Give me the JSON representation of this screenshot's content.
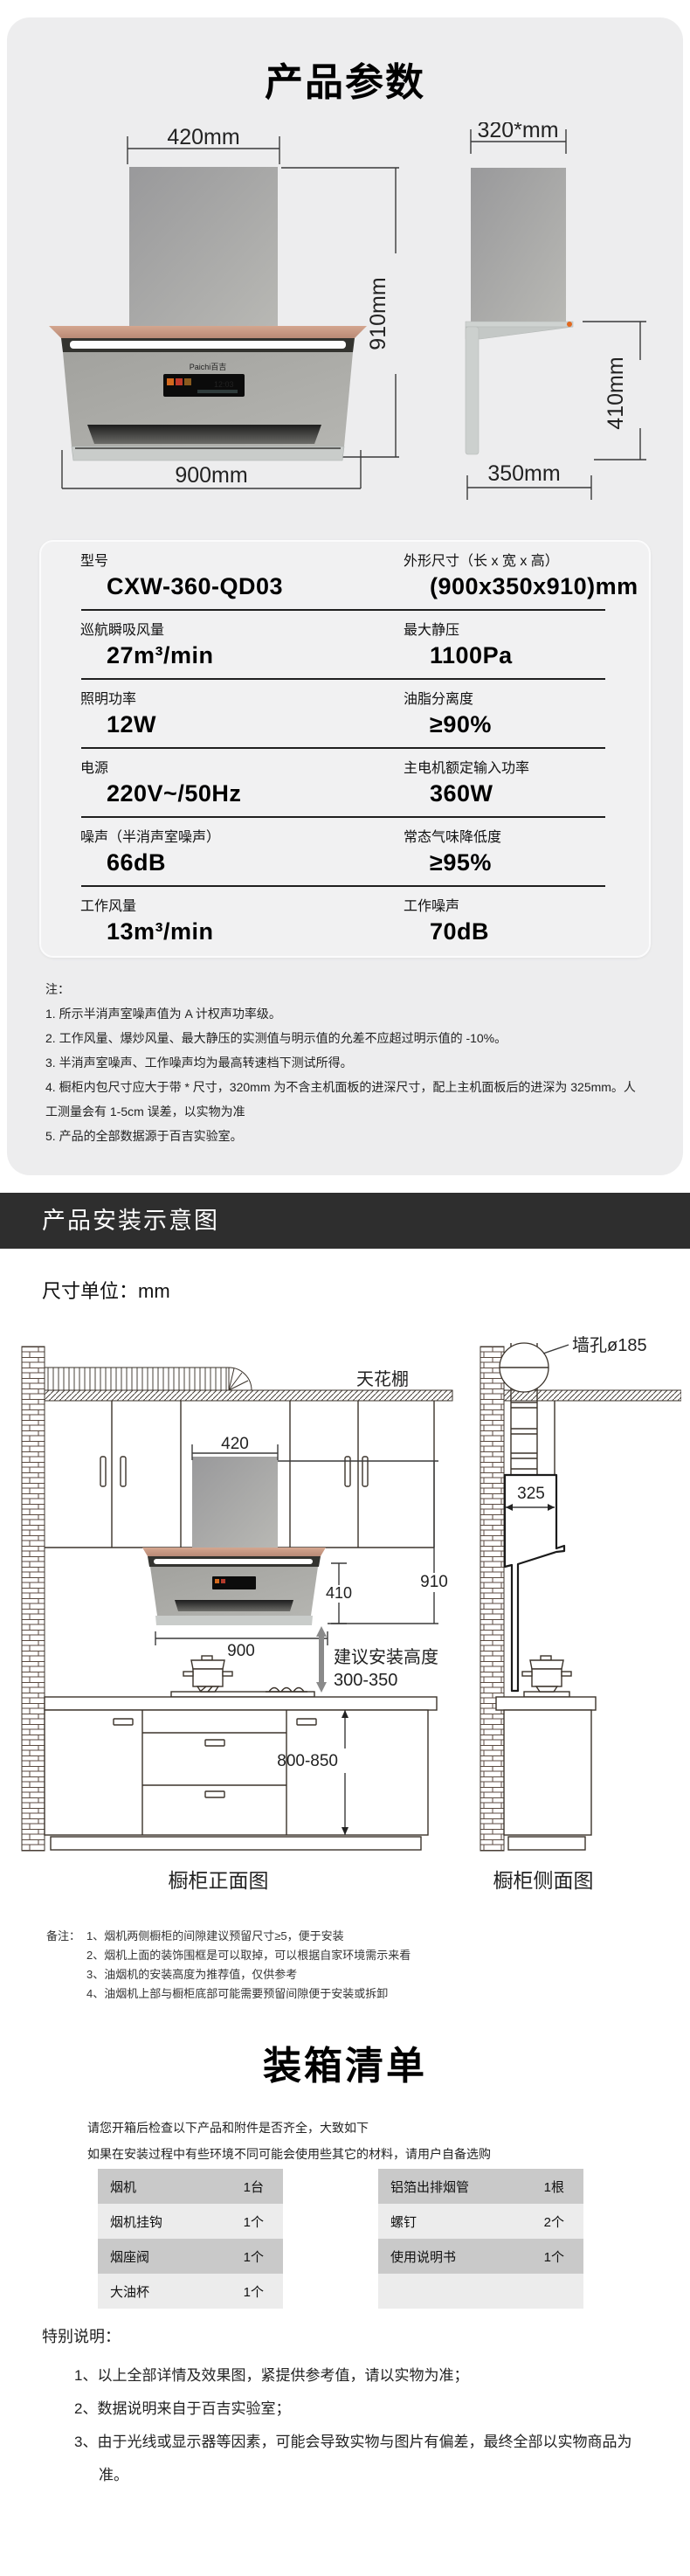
{
  "section_params": {
    "title": "产品参数",
    "front_view": {
      "width_top": "420mm",
      "height": "910mm",
      "width_bottom": "900mm",
      "brand": "Paichi百吉",
      "screen_time": "12:03"
    },
    "side_view": {
      "depth_top": "320*mm",
      "height": "410mm",
      "depth_bottom": "350mm"
    },
    "spec_rows": [
      {
        "l_label": "型号",
        "l_value": "CXW-360-QD03",
        "r_label": "外形尺寸（长 x 宽 x 高）",
        "r_value": "(900x350x910)mm"
      },
      {
        "l_label": "巡航瞬吸风量",
        "l_value": "27m³/min",
        "r_label": "最大静压",
        "r_value": "1100Pa"
      },
      {
        "l_label": "照明功率",
        "l_value": "12W",
        "r_label": "油脂分离度",
        "r_value": "≥90%"
      },
      {
        "l_label": "电源",
        "l_value": "220V~/50Hz",
        "r_label": "主电机额定输入功率",
        "r_value": "360W"
      },
      {
        "l_label": "噪声（半消声室噪声）",
        "l_value": "66dB",
        "r_label": "常态气味降低度",
        "r_value": "≥95%"
      },
      {
        "l_label": "工作风量",
        "l_value": "13m³/min",
        "r_label": "工作噪声",
        "r_value": "70dB"
      }
    ],
    "notes_title": "注：",
    "notes": [
      "1. 所示半消声室噪声值为 A 计权声功率级。",
      "2. 工作风量、爆炒风量、最大静压的实测值与明示值的允差不应超过明示值的 -10%。",
      "3. 半消声室噪声、工作噪声均为最高转速档下测试所得。",
      "4. 橱柜内包尺寸应大于带 * 尺寸，320mm 为不含主机面板的进深尺寸，配上主机面板后的进深为 325mm。人工测量会有 1-5cm 误差，以实物为准",
      "5. 产品的全部数据源于百吉实验室。"
    ]
  },
  "section_install": {
    "banner": "产品安装示意图",
    "unit_label": "尺寸单位：mm",
    "diagram": {
      "ceiling": "天花棚",
      "wall_hole": "墙孔ø185",
      "dim_420": "420",
      "dim_910": "910",
      "dim_410": "410",
      "dim_900": "900",
      "dim_325": "325",
      "install_height_line1": "建议安装高度",
      "install_height_line2": "300-350",
      "counter_height": "800-850",
      "front_caption": "橱柜正面图",
      "side_caption": "橱柜侧面图"
    },
    "remarks_label": "备注：",
    "remarks": [
      "1、烟机两侧橱柜的间隙建议预留尺寸≥5，便于安装",
      "2、烟机上面的装饰围框是可以取掉，可以根据自家环境需示来看",
      "3、油烟机的安装高度为推荐值，仅供参考",
      "4、油烟机上部与橱柜底部可能需要预留间隙便于安装或拆卸"
    ]
  },
  "section_packing": {
    "title": "装箱清单",
    "intro": [
      "请您开箱后检查以下产品和附件是否齐全，大致如下",
      "如果在安装过程中有些环境不同可能会使用些其它的材料，请用户自备选购"
    ],
    "left_table": [
      {
        "name": "烟机",
        "qty": "1台"
      },
      {
        "name": "烟机挂钩",
        "qty": "1个"
      },
      {
        "name": "烟座阀",
        "qty": "1个"
      },
      {
        "name": "大油杯",
        "qty": "1个"
      }
    ],
    "right_table": [
      {
        "name": "铝箔出排烟管",
        "qty": "1根"
      },
      {
        "name": "螺钉",
        "qty": "2个"
      },
      {
        "name": "使用说明书",
        "qty": "1个"
      },
      {
        "name": "",
        "qty": ""
      }
    ],
    "special_label": "特别说明：",
    "special": [
      "1、以上全部详情及效果图，紧提供参考值，请以实物为准；",
      "2、数据说明来自于百吉实验室；",
      "3、由于光线或显示器等因素，可能会导致实物与图片有偏差，最终全部以实物商品为准。"
    ]
  }
}
